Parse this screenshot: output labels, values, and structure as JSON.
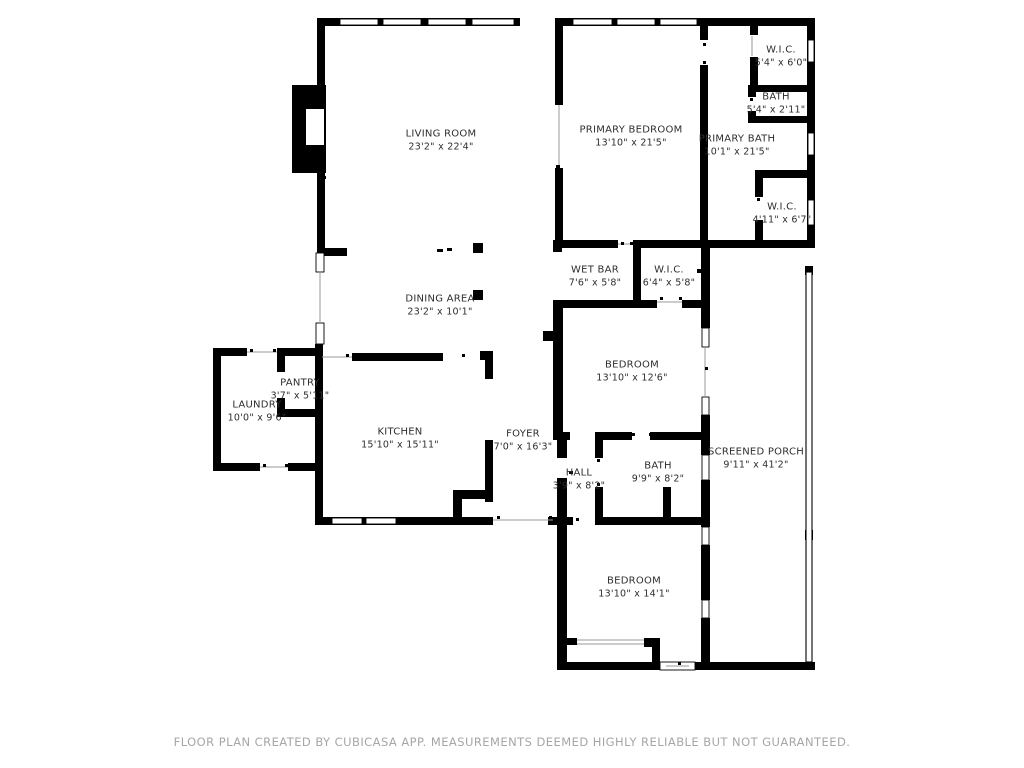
{
  "plan": {
    "rooms": [
      {
        "id": "living-room",
        "name": "LIVING ROOM",
        "dims": "23'2\" x 22'4\""
      },
      {
        "id": "primary-bedroom",
        "name": "PRIMARY BEDROOM",
        "dims": "13'10\" x 21'5\""
      },
      {
        "id": "primary-bath",
        "name": "PRIMARY BATH",
        "dims": "10'1\" x 21'5\""
      },
      {
        "id": "wic-top",
        "name": "W.I.C.",
        "dims": "5'4\" x 6'0\""
      },
      {
        "id": "bath-small",
        "name": "BATH",
        "dims": "5'4\" x 2'11\""
      },
      {
        "id": "wic-right",
        "name": "W.I.C.",
        "dims": "4'11\" x 6'7\""
      },
      {
        "id": "wet-bar",
        "name": "WET BAR",
        "dims": "7'6\" x 5'8\""
      },
      {
        "id": "wic-mid",
        "name": "W.I.C.",
        "dims": "6'4\" x 5'8\""
      },
      {
        "id": "dining-area",
        "name": "DINING AREA",
        "dims": "23'2\" x 10'1\""
      },
      {
        "id": "bedroom-mid",
        "name": "BEDROOM",
        "dims": "13'10\" x 12'6\""
      },
      {
        "id": "pantry",
        "name": "PANTRY",
        "dims": "3'7\" x 5'11\""
      },
      {
        "id": "laundry",
        "name": "LAUNDRY",
        "dims": "10'0\" x 9'6\""
      },
      {
        "id": "kitchen",
        "name": "KITCHEN",
        "dims": "15'10\" x 15'11\""
      },
      {
        "id": "foyer",
        "name": "FOYER",
        "dims": "7'0\" x 16'3\""
      },
      {
        "id": "hall",
        "name": "HALL",
        "dims": "3'9\" x 8'2\""
      },
      {
        "id": "bath-main",
        "name": "BATH",
        "dims": "9'9\" x 8'2\""
      },
      {
        "id": "screened-porch",
        "name": "SCREENED PORCH",
        "dims": "9'11\" x 41'2\""
      },
      {
        "id": "bedroom-bottom",
        "name": "BEDROOM",
        "dims": "13'10\" x 14'1\""
      }
    ],
    "footer": "FLOOR PLAN CREATED BY CUBICASA APP. MEASUREMENTS DEEMED HIGHLY RELIABLE BUT NOT GUARANTEED.",
    "colors": {
      "wall": "#000000",
      "label": "#2e2e2e",
      "footer": "#a6a6a6",
      "door_line": "#9a9a9a"
    }
  }
}
